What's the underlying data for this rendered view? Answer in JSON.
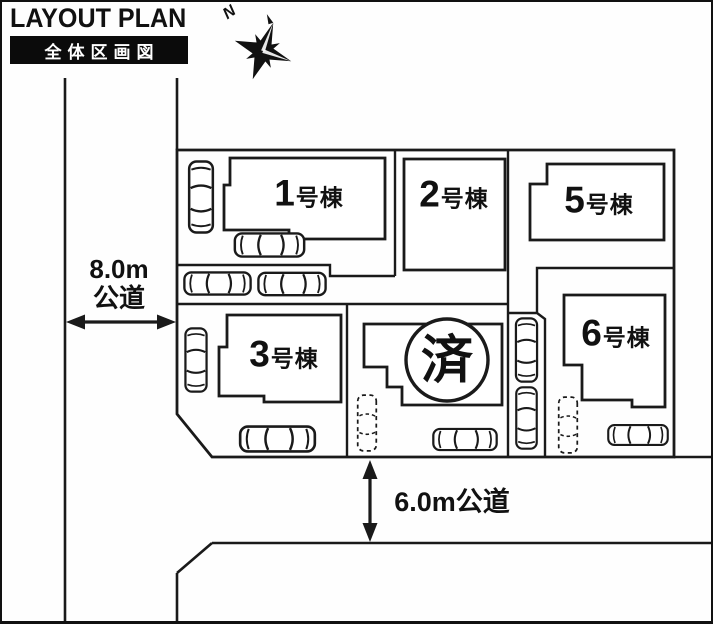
{
  "header": {
    "title": "LAYOUT PLAN",
    "subtitle": "全体区画図"
  },
  "compass": {
    "label": "N"
  },
  "roads": {
    "west": {
      "line1": "8.0m",
      "line2": "公道"
    },
    "south": {
      "label": "6.0m公道"
    }
  },
  "buildings": {
    "b1": {
      "number": "1",
      "suffix": "号棟"
    },
    "b2": {
      "number": "2",
      "suffix": "号棟"
    },
    "b3": {
      "number": "3",
      "suffix": "号棟"
    },
    "b5": {
      "number": "5",
      "suffix": "号棟"
    },
    "b6": {
      "number": "6",
      "suffix": "号棟"
    }
  },
  "sold": {
    "label": "済"
  },
  "icons": {
    "compass": "compass-rose-icon",
    "car": "car-top-view-icon",
    "parking_space": "dashed-parking-space-icon",
    "dimension_arrow": "double-headed-arrow-icon"
  },
  "colors": {
    "line": "#1a1a1a",
    "background": "#fefefe",
    "subtitle_bg": "#0b0b0b",
    "subtitle_text": "#ffffff"
  }
}
